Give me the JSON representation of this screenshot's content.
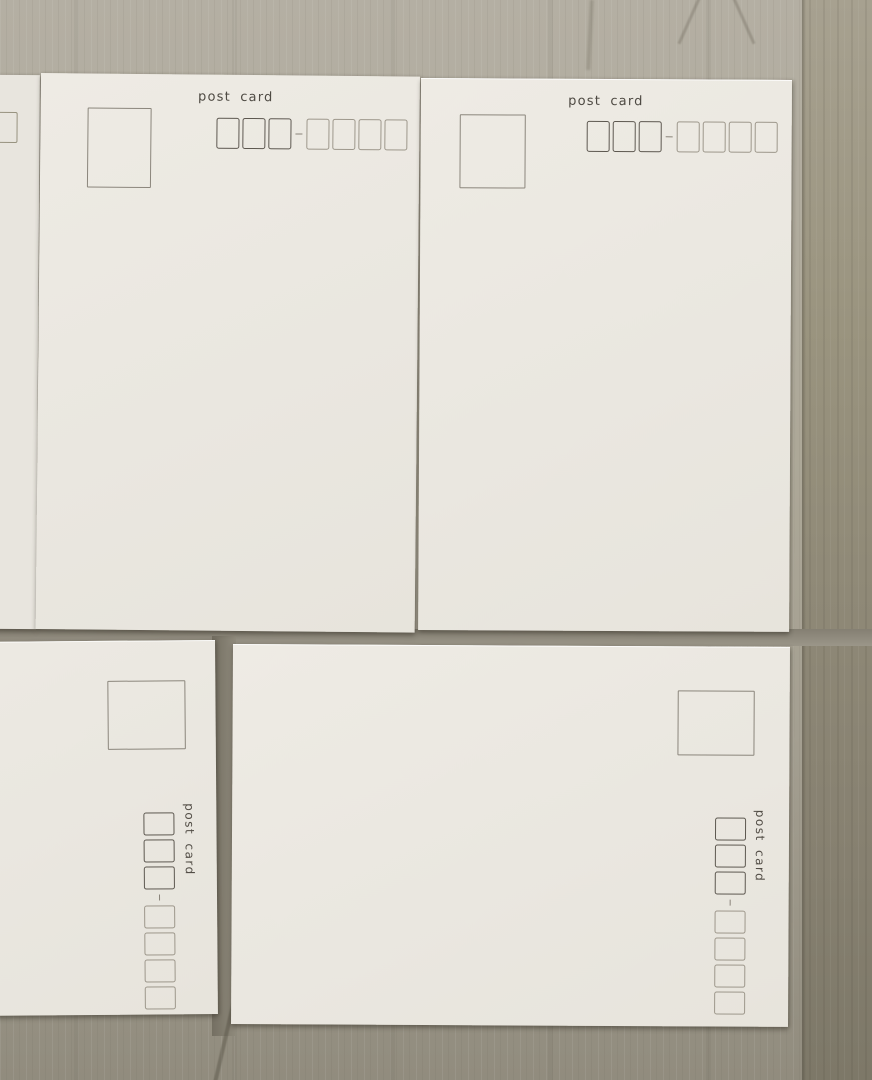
{
  "scene": {
    "full_postcards_visible": 4,
    "partial_postcards_visible": 1,
    "surface": "light wooden table"
  },
  "cards": [
    {
      "id": "top-left",
      "label": "post card",
      "orientation": "upright"
    },
    {
      "id": "top-right",
      "label": "post card",
      "orientation": "upright"
    },
    {
      "id": "bottom-left",
      "label": "post card",
      "orientation": "rotated-90-clockwise"
    },
    {
      "id": "bottom-right",
      "label": "post card",
      "orientation": "rotated-90-clockwise"
    }
  ],
  "postal_code_boxes": {
    "bold_count": 3,
    "light_count": 4,
    "separator": "dash"
  },
  "colors": {
    "card_paper": "#ebe8e1",
    "wood_light": "#ada898",
    "wood_dark_band": "#8b8574",
    "box_border_bold": "#5d5850",
    "box_border_light": "#9d978b",
    "stamp_border": "#8b867c",
    "text": "#4e4a43"
  }
}
